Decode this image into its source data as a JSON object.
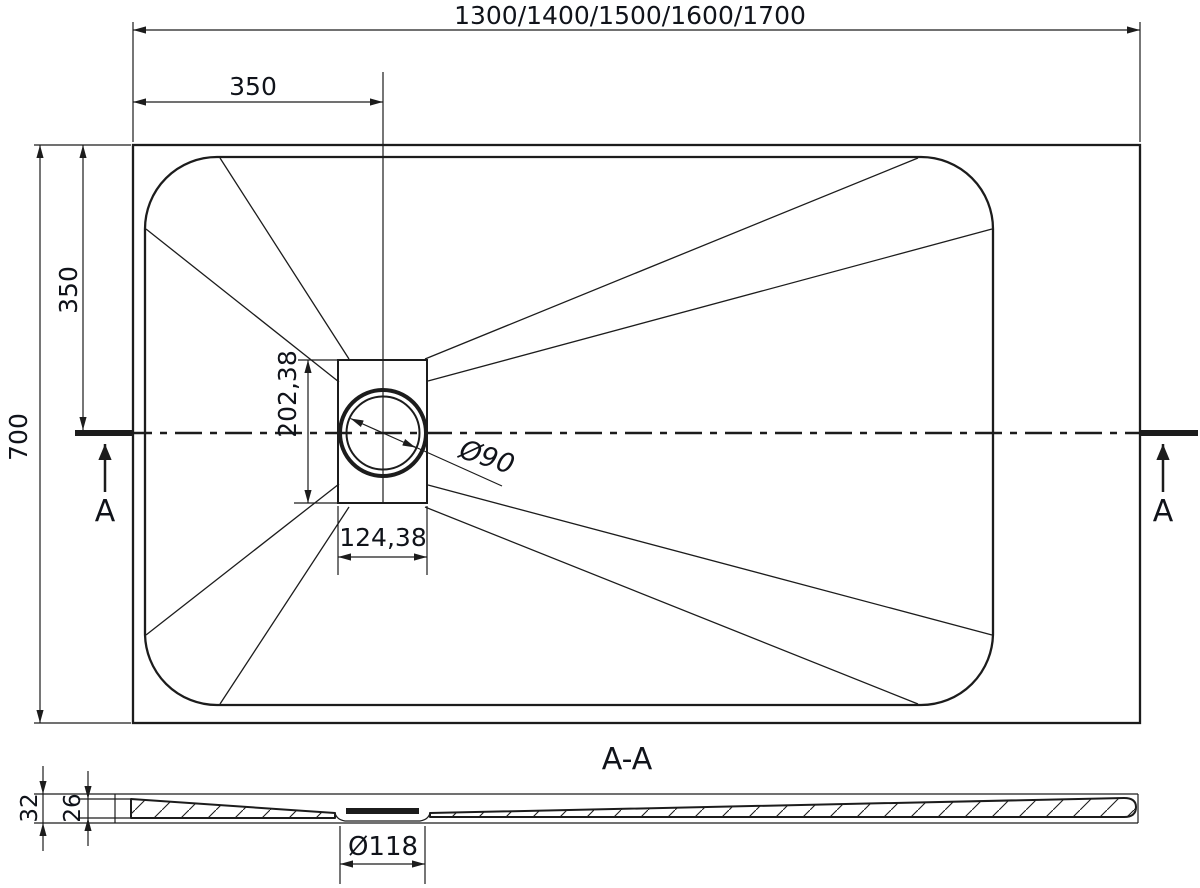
{
  "drawing": {
    "background": "#ffffff",
    "line_color": "#1c1c1c",
    "text_color": "#10131a"
  },
  "top_view": {
    "length_options": "1300/1400/1500/1600/1700",
    "overall_width": "700",
    "drain_offset_from_left": "350",
    "drain_offset_from_top": "350",
    "drain_box_height": "202,38",
    "drain_box_width": "124,38",
    "drain_diameter": "Ø90",
    "section_marker": "A"
  },
  "section_view": {
    "title": "A-A",
    "total_height": "32",
    "base_height": "26",
    "drain_recess_diameter": "Ø118"
  }
}
